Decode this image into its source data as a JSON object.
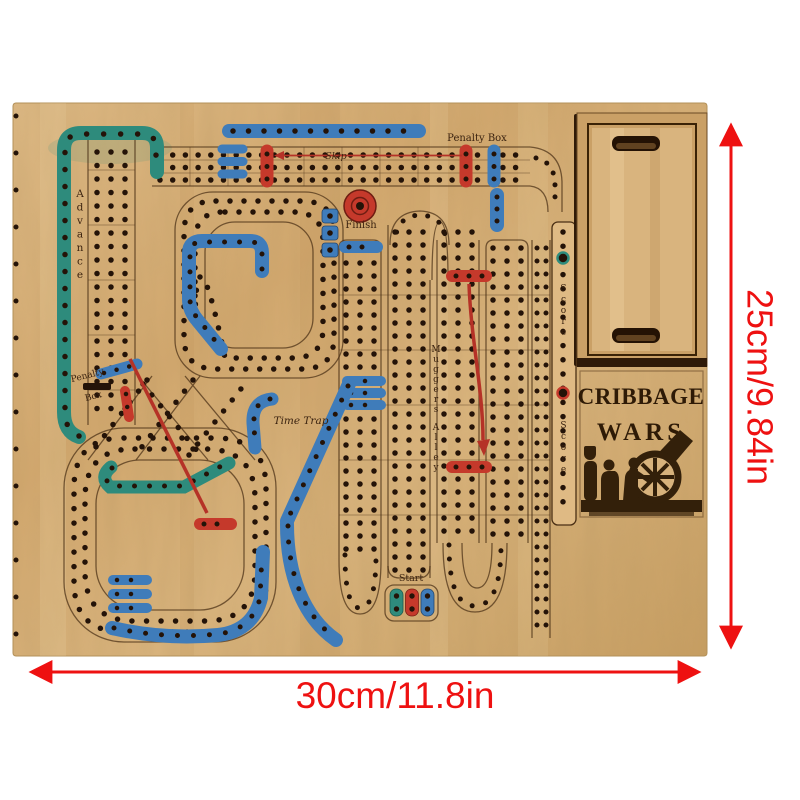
{
  "board": {
    "title": {
      "line1": "CRIBBAGE",
      "line2": "WARS"
    },
    "labels": {
      "skip": "Skip",
      "penalty_box_top": "Penalty Box",
      "finish": "Finish",
      "advance": "Advance",
      "penalty_mid_1": "Penalty",
      "penalty_mid_2": "Box",
      "time_trap": "Time Trap",
      "muggers_alley": "Muggers Alley",
      "score_upper": "Score",
      "score_lower": "Score",
      "start": "Start"
    },
    "colors": {
      "wood": "#d9b077",
      "teal_track": "#2e8b7c",
      "blue_track": "#3f7cba",
      "red_track": "#c5392b",
      "engraving": "#33200a",
      "holes": "#241308"
    }
  },
  "dimensions": {
    "height": "25cm/9.84in",
    "width": "30cm/11.8in",
    "arrow_color": "#ee1111"
  }
}
